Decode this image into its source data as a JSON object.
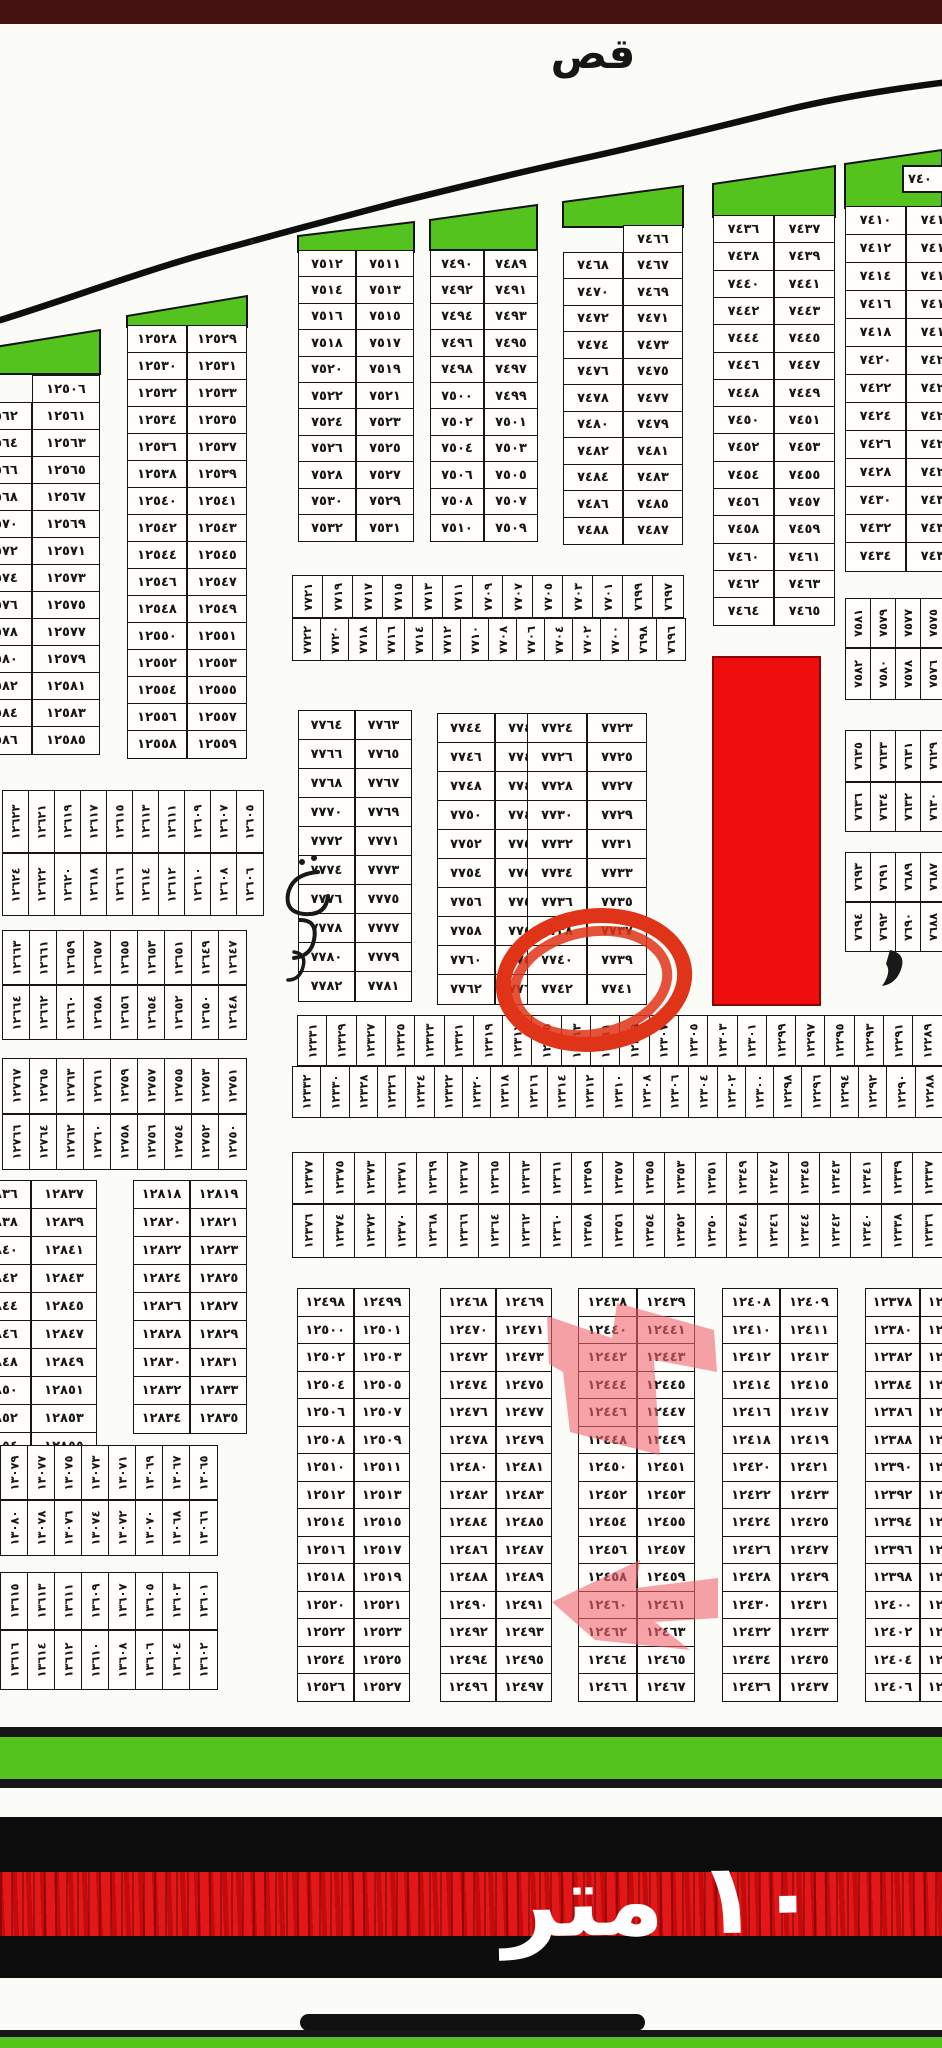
{
  "document": {
    "top_label": "قص",
    "street_width_label": "١٠ متر",
    "digit_style": "arabic-indic",
    "annotations": {
      "circled_plot": 7742,
      "corner_fragment": "٧٤٠",
      "pink_highlighted_plot_rows": [
        [
          12440,
          12447
        ],
        [
          12460,
          12463
        ]
      ]
    }
  },
  "colors": {
    "paper": "#fbfbf8",
    "ink": "#161616",
    "green": "#54c31d",
    "red_block": "#ee0e0e",
    "marker_red": "#e03418",
    "pink_highlight": "rgba(240,100,110,0.6)",
    "top_bar": "#451111",
    "road_black": "#0c0c0c",
    "road_red": "#dd0f0f",
    "street_text_color": "#ffffff"
  },
  "layout": {
    "blocks": [
      {
        "id": "block-12561",
        "x": -36,
        "y": 375,
        "colW": 68,
        "rowH": 27,
        "rows": 13,
        "left_start": 12562,
        "right_start": 12561,
        "top_single": 12506,
        "clipW": 138
      },
      {
        "id": "block-12528",
        "x": 127,
        "y": 325,
        "colW": 60,
        "rowH": 27,
        "rows": 16,
        "left_start": 12528,
        "right_start": 12529
      },
      {
        "id": "block-7511",
        "x": 298,
        "y": 250,
        "colW": 58,
        "rowH": 26.4,
        "rows": 11,
        "left_start": 7512,
        "right_start": 7511
      },
      {
        "id": "block-7489",
        "x": 430,
        "y": 250,
        "colW": 54,
        "rowH": 26.4,
        "rows": 11,
        "left_start": 7490,
        "right_start": 7489
      },
      {
        "id": "block-7466",
        "x": 563,
        "y": 225,
        "colW": 60,
        "rowH": 26.5,
        "rows": 11,
        "left_start": 7468,
        "right_start": 7467,
        "top_single": 7466
      },
      {
        "id": "block-7436",
        "x": 713,
        "y": 215,
        "colW": 61,
        "rowH": 27.3,
        "rows": 15,
        "left_start": 7436,
        "right_start": 7437
      },
      {
        "id": "block-7410",
        "x": 845,
        "y": 206,
        "colW": 61,
        "rowH": 28,
        "rows": 13,
        "left_start": 7410,
        "right_start": 7411,
        "clipW": 97
      },
      {
        "id": "block-7763",
        "x": 298,
        "y": 710,
        "colW": 57,
        "rowH": 29,
        "rows": 10,
        "left_start": 7764,
        "right_start": 7763
      },
      {
        "id": "block-7743",
        "x": 437,
        "y": 713,
        "colW": 58,
        "rowH": 29,
        "rows": 10,
        "left_start": 7744,
        "right_start": 7743
      },
      {
        "id": "block-7723",
        "x": 527,
        "y": 713,
        "colW": 60,
        "rowH": 29,
        "rows": 10,
        "left_start": 7724,
        "right_start": 7723
      },
      {
        "id": "block-12836",
        "x": -35,
        "y": 1180,
        "colW": 66,
        "rowH": 28,
        "rows": 10,
        "left_start": 12836,
        "right_start": 12837,
        "clipW": 132
      },
      {
        "id": "block-12818",
        "x": 133,
        "y": 1180,
        "colW": 57,
        "rowH": 28,
        "rows": 9,
        "left_start": 12818,
        "right_start": 12819
      },
      {
        "id": "block-12498",
        "x": 297,
        "y": 1288,
        "colW": 56.5,
        "rowH": 27.5,
        "rows": 15,
        "left_start": 12498,
        "right_start": 12499
      },
      {
        "id": "block-12468",
        "x": 440,
        "y": 1288,
        "colW": 56,
        "rowH": 27.5,
        "rows": 15,
        "left_start": 12468,
        "right_start": 12469
      },
      {
        "id": "block-12438",
        "x": 578,
        "y": 1288,
        "colW": 58.5,
        "rowH": 27.5,
        "rows": 15,
        "left_start": 12438,
        "right_start": 12439
      },
      {
        "id": "block-12408",
        "x": 722,
        "y": 1288,
        "colW": 58,
        "rowH": 27.5,
        "rows": 15,
        "left_start": 12408,
        "right_start": 12409
      },
      {
        "id": "block-12378",
        "x": 865,
        "y": 1288,
        "colW": 55,
        "rowH": 27.5,
        "rows": 15,
        "left_start": 12378,
        "right_start": 12379,
        "clipW": 77
      }
    ],
    "strips": [
      {
        "id": "strip-7721",
        "x": 292,
        "y": 575,
        "cellW": 30,
        "cellH": 43,
        "count": 13,
        "start": 7721,
        "step": -2
      },
      {
        "id": "strip-7722",
        "x": 292,
        "y": 618,
        "cellW": 28,
        "cellH": 43,
        "count": 14,
        "start": 7722,
        "step": -2
      },
      {
        "id": "strip-12331",
        "x": 297,
        "y": 1015,
        "cellW": 29.3,
        "cellH": 51,
        "count": 22,
        "start": 12331,
        "step": -2
      },
      {
        "id": "strip-12332",
        "x": 292,
        "y": 1066,
        "cellW": 28.3,
        "cellH": 52,
        "count": 23,
        "start": 12332,
        "step": -2
      },
      {
        "id": "strip-12377",
        "x": 292,
        "y": 1152,
        "cellW": 31,
        "cellH": 52,
        "count": 21,
        "start": 12377,
        "step": -2
      },
      {
        "id": "strip-12376",
        "x": 292,
        "y": 1204,
        "cellW": 31,
        "cellH": 54,
        "count": 21,
        "start": 12376,
        "step": -2
      },
      {
        "id": "strip-12623",
        "x": 2,
        "y": 790,
        "cellW": 26,
        "cellH": 63,
        "count": 10,
        "start": 12623,
        "step": -2
      },
      {
        "id": "strip-12624",
        "x": 2,
        "y": 853,
        "cellW": 26,
        "cellH": 63,
        "count": 10,
        "start": 12624,
        "step": -2
      },
      {
        "id": "strip-12663",
        "x": 2,
        "y": 930,
        "cellW": 27,
        "cellH": 55,
        "count": 9,
        "start": 12663,
        "step": -2
      },
      {
        "id": "strip-12664",
        "x": 2,
        "y": 985,
        "cellW": 27,
        "cellH": 55,
        "count": 9,
        "start": 12664,
        "step": -2
      },
      {
        "id": "strip-12767",
        "x": 2,
        "y": 1058,
        "cellW": 27,
        "cellH": 56,
        "count": 9,
        "start": 12767,
        "step": -2
      },
      {
        "id": "strip-12766",
        "x": 2,
        "y": 1114,
        "cellW": 27,
        "cellH": 56,
        "count": 9,
        "start": 12766,
        "step": -2
      },
      {
        "id": "strip-13079",
        "x": 0,
        "y": 1445,
        "cellW": 27,
        "cellH": 55,
        "count": 8,
        "start": 13079,
        "step": -2
      },
      {
        "id": "strip-13080",
        "x": 0,
        "y": 1500,
        "cellW": 27,
        "cellH": 56,
        "count": 8,
        "start": 13080,
        "step": -2
      },
      {
        "id": "strip-13615",
        "x": 0,
        "y": 1572,
        "cellW": 27,
        "cellH": 58,
        "count": 8,
        "start": 13615,
        "step": -2
      },
      {
        "id": "strip-13616",
        "x": 0,
        "y": 1630,
        "cellW": 27,
        "cellH": 60,
        "count": 8,
        "start": 13616,
        "step": -2
      },
      {
        "id": "strip-7581",
        "x": 845,
        "y": 598,
        "cellW": 25,
        "cellH": 50,
        "count": 4,
        "start": 7581,
        "step": -2
      },
      {
        "id": "strip-7582",
        "x": 845,
        "y": 648,
        "cellW": 25,
        "cellH": 52,
        "count": 4,
        "start": 7582,
        "step": -2
      },
      {
        "id": "strip-7635",
        "x": 845,
        "y": 730,
        "cellW": 25,
        "cellH": 52,
        "count": 4,
        "start": 7635,
        "step": -2
      },
      {
        "id": "strip-7636",
        "x": 845,
        "y": 782,
        "cellW": 25,
        "cellH": 50,
        "count": 4,
        "start": 7636,
        "step": -2
      },
      {
        "id": "strip-7693",
        "x": 845,
        "y": 852,
        "cellW": 25,
        "cellH": 50,
        "count": 4,
        "start": 7693,
        "step": -2
      },
      {
        "id": "strip-7694",
        "x": 845,
        "y": 902,
        "cellW": 25,
        "cellH": 50,
        "count": 4,
        "start": 7694,
        "step": -2
      }
    ]
  }
}
